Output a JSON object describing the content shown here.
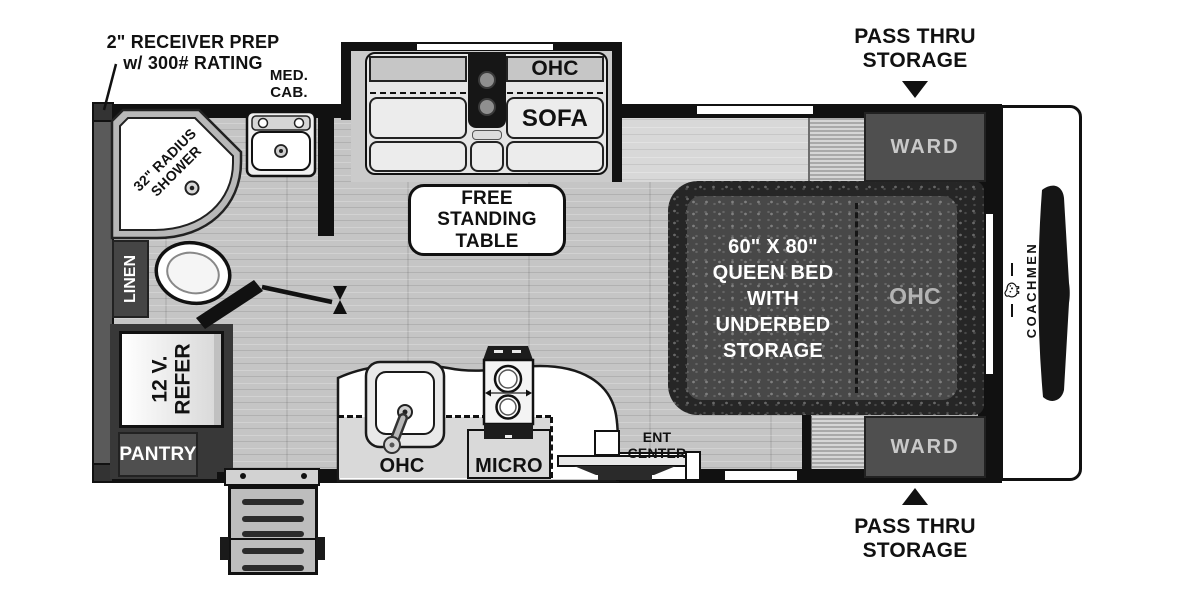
{
  "colors": {
    "wall": "#111111",
    "floor": "#c5c5c5",
    "cabinet_dark": "#4f4f4f",
    "bed_dark": "#262626",
    "label_light": "#c9c9c9"
  },
  "exterior": {
    "receiver_prep": "2\" RECEIVER PREP\nw/ 300# RATING",
    "pass_thru": "PASS THRU\nSTORAGE"
  },
  "bath": {
    "med_cab": "MED.\nCAB.",
    "shower": "32\" RADIUS\nSHOWER",
    "linen": "LINEN"
  },
  "living": {
    "sofa_ohc": "OHC",
    "sofa": "SOFA",
    "table": "FREE\nSTANDING\nTABLE"
  },
  "galley": {
    "refer": "12 V.\nREFER",
    "pantry": "PANTRY",
    "ohc": "OHC",
    "micro": "MICRO",
    "ent_center": "ENT CENTER"
  },
  "bedroom": {
    "ward": "WARD",
    "bed": "60\" X 80\"\nQUEEN BED\nWITH\nUNDERBED\nSTORAGE",
    "ohc": "OHC"
  },
  "brand": {
    "name": "COACHMEN"
  }
}
